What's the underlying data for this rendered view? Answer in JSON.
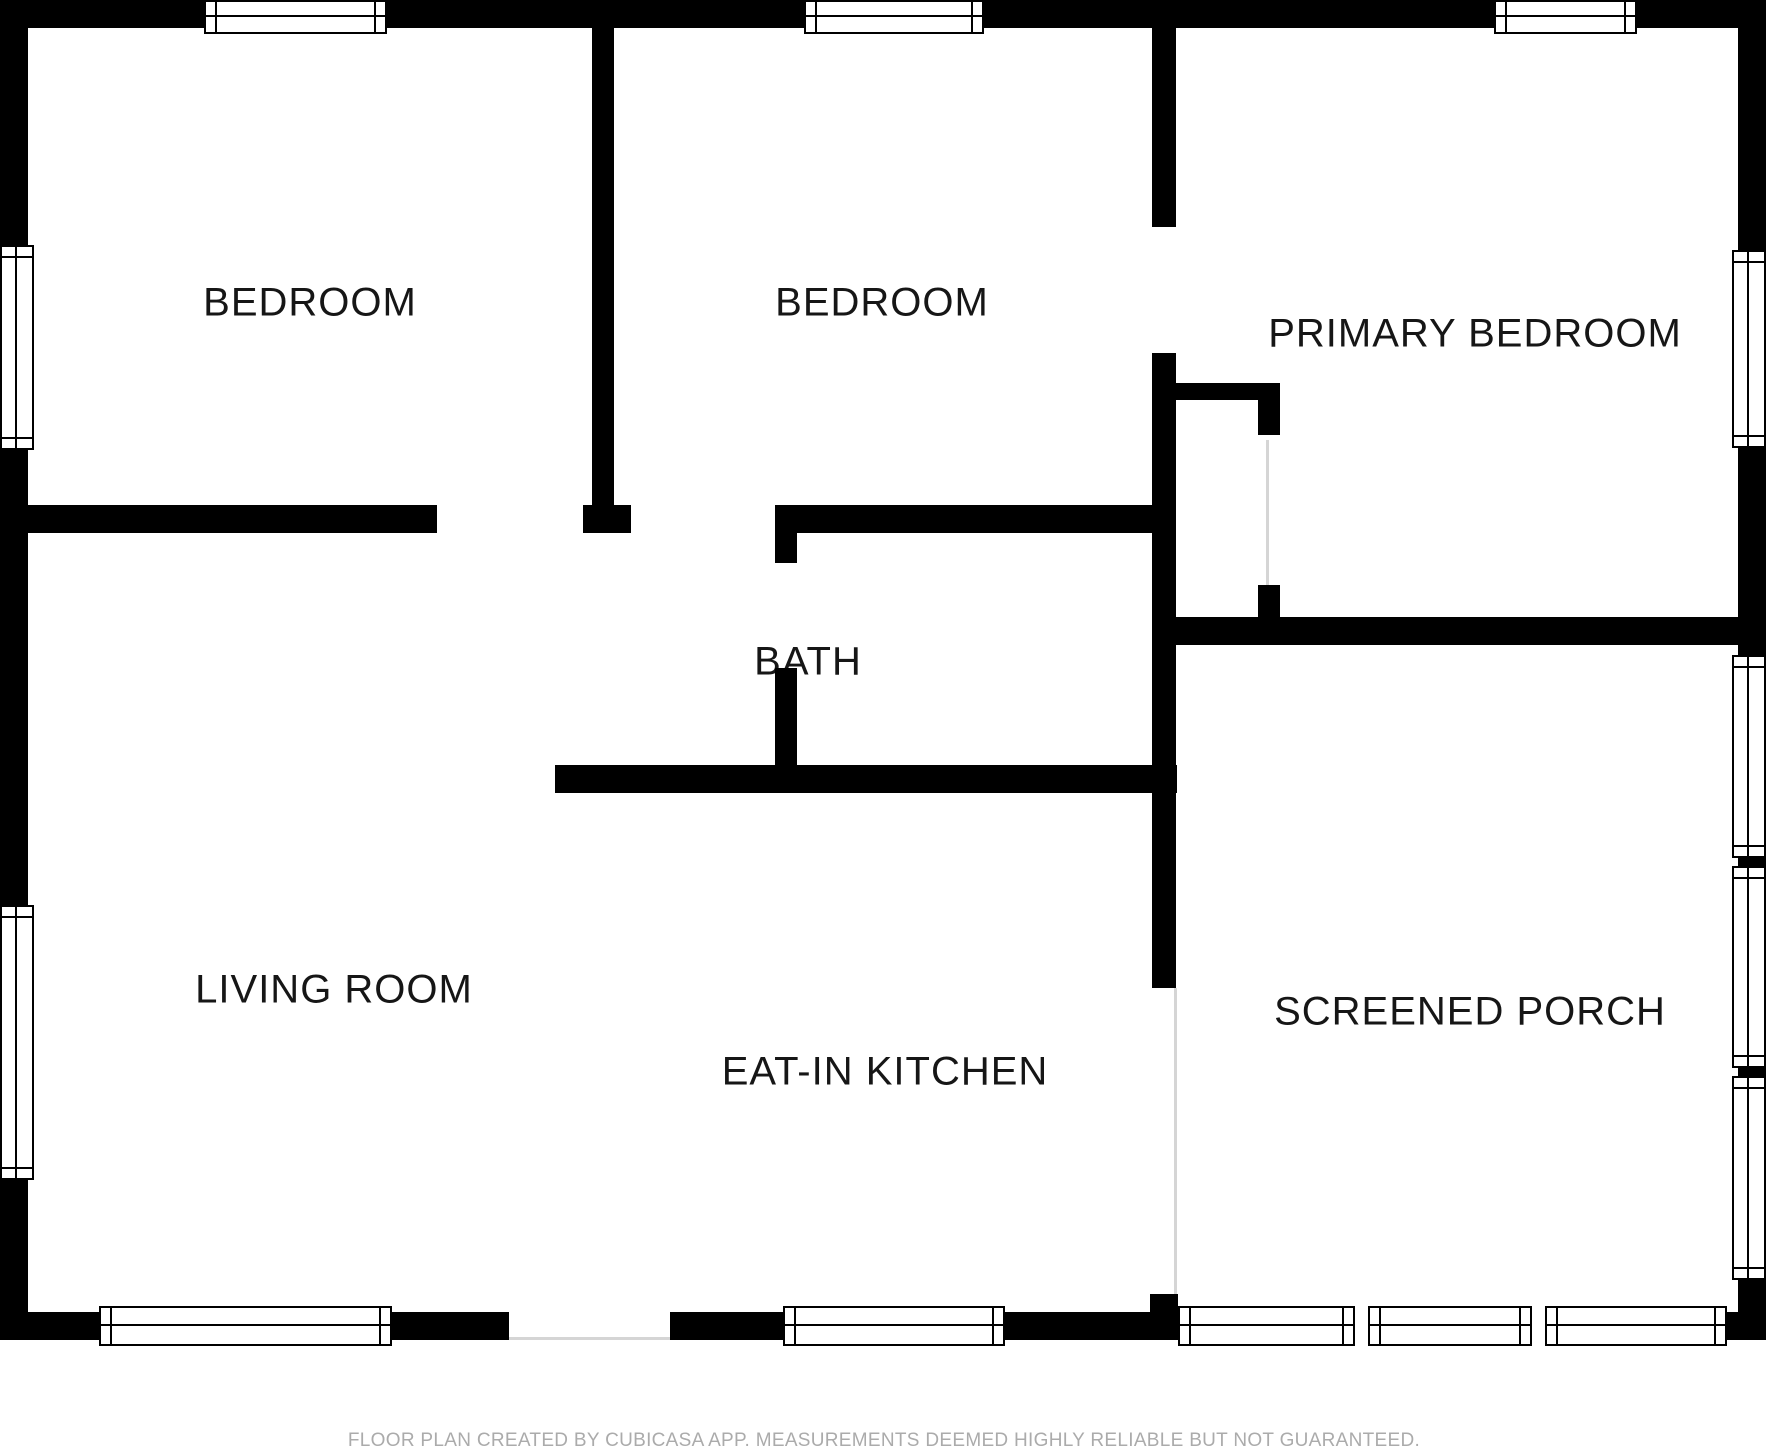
{
  "footer": {
    "text": "FLOOR PLAN CREATED BY CUBICASA APP. MEASUREMENTS DEEMED HIGHLY RELIABLE BUT NOT GUARANTEED."
  },
  "colors": {
    "wall": "#000000",
    "background": "#ffffff",
    "label_text": "#161616",
    "footer_text": "#ababab",
    "seam": "#d5d5d5"
  },
  "rooms": [
    {
      "name": "BEDROOM",
      "x": 310,
      "y": 303
    },
    {
      "name": "BEDROOM",
      "x": 882,
      "y": 303
    },
    {
      "name": "PRIMARY BEDROOM",
      "x": 1475,
      "y": 334
    },
    {
      "name": "BATH",
      "x": 808,
      "y": 662
    },
    {
      "name": "LIVING ROOM",
      "x": 334,
      "y": 990
    },
    {
      "name": "EAT-IN KITCHEN",
      "x": 885,
      "y": 1072
    },
    {
      "name": "SCREENED PORCH",
      "x": 1470,
      "y": 1012
    }
  ],
  "plan": {
    "walls": [
      [
        "top-exterior-wall",
        0,
        0,
        1766,
        28
      ],
      [
        "left-exterior-wall",
        0,
        0,
        28,
        1340
      ],
      [
        "right-exterior-wall",
        1738,
        0,
        28,
        1340
      ],
      [
        "bottom-wall-segment-a",
        0,
        1312,
        99,
        28
      ],
      [
        "bottom-wall-segment-b",
        392,
        1312,
        117,
        28
      ],
      [
        "bottom-wall-segment-c",
        670,
        1312,
        113,
        28
      ],
      [
        "bottom-wall-segment-d",
        1005,
        1312,
        173,
        28
      ],
      [
        "bottom-wall-segment-e",
        1727,
        1312,
        39,
        28
      ],
      [
        "porch-kitchen-wall-stub",
        1150,
        1294,
        28,
        46
      ],
      [
        "bedroom1-bottom-wall",
        28,
        505,
        409,
        28
      ],
      [
        "bedroom-divider-cap",
        583,
        505,
        48,
        28
      ],
      [
        "bath-top-wall",
        775,
        505,
        377,
        28
      ],
      [
        "bedroom1-bedroom2-divider",
        592,
        28,
        22,
        477
      ],
      [
        "bedroom2-primary-wall-upper",
        1152,
        28,
        24,
        199
      ],
      [
        "hall-wall-main",
        1152,
        353,
        24,
        635
      ],
      [
        "closet-top-wall",
        1152,
        383,
        128,
        17
      ],
      [
        "closet-right-wall-upper",
        1258,
        400,
        22,
        35
      ],
      [
        "closet-right-wall-lower",
        1258,
        585,
        22,
        60
      ],
      [
        "primary-porch-divider-wall",
        1152,
        617,
        614,
        28
      ],
      [
        "bath-left-wall-upper",
        775,
        533,
        22,
        30
      ],
      [
        "bath-left-wall-lower",
        775,
        668,
        22,
        125
      ],
      [
        "kitchen-top-wall",
        555,
        765,
        622,
        28
      ]
    ],
    "windows": [
      [
        "top-window-bedroom1",
        204,
        0,
        183,
        34,
        "h"
      ],
      [
        "top-window-bedroom2",
        804,
        0,
        180,
        34,
        "h"
      ],
      [
        "top-window-primary",
        1494,
        0,
        143,
        34,
        "h"
      ],
      [
        "left-window-bedroom1",
        0,
        245,
        34,
        205,
        "v"
      ],
      [
        "left-window-living",
        0,
        905,
        34,
        275,
        "v"
      ],
      [
        "right-window-primary",
        1732,
        250,
        34,
        198,
        "v"
      ],
      [
        "right-window-porch-1",
        1732,
        655,
        34,
        203,
        "v"
      ],
      [
        "right-window-porch-2",
        1732,
        866,
        34,
        202,
        "v"
      ],
      [
        "right-window-porch-3",
        1732,
        1076,
        34,
        204,
        "v"
      ],
      [
        "bottom-window-living",
        99,
        1306,
        293,
        40,
        "h"
      ],
      [
        "bottom-window-kitchen",
        783,
        1306,
        222,
        40,
        "h"
      ],
      [
        "bottom-window-porch-1",
        1178,
        1306,
        177,
        40,
        "h"
      ],
      [
        "bottom-window-porch-2",
        1368,
        1306,
        164,
        40,
        "h"
      ],
      [
        "bottom-window-porch-3",
        1545,
        1306,
        182,
        40,
        "h"
      ]
    ],
    "seams": [
      [
        "porch-kitchen-opening-seam",
        1174,
        988,
        3,
        306
      ],
      [
        "front-door-threshold",
        509,
        1337,
        161,
        3
      ],
      [
        "closet-door-seam",
        1266,
        440,
        3,
        145
      ]
    ]
  }
}
